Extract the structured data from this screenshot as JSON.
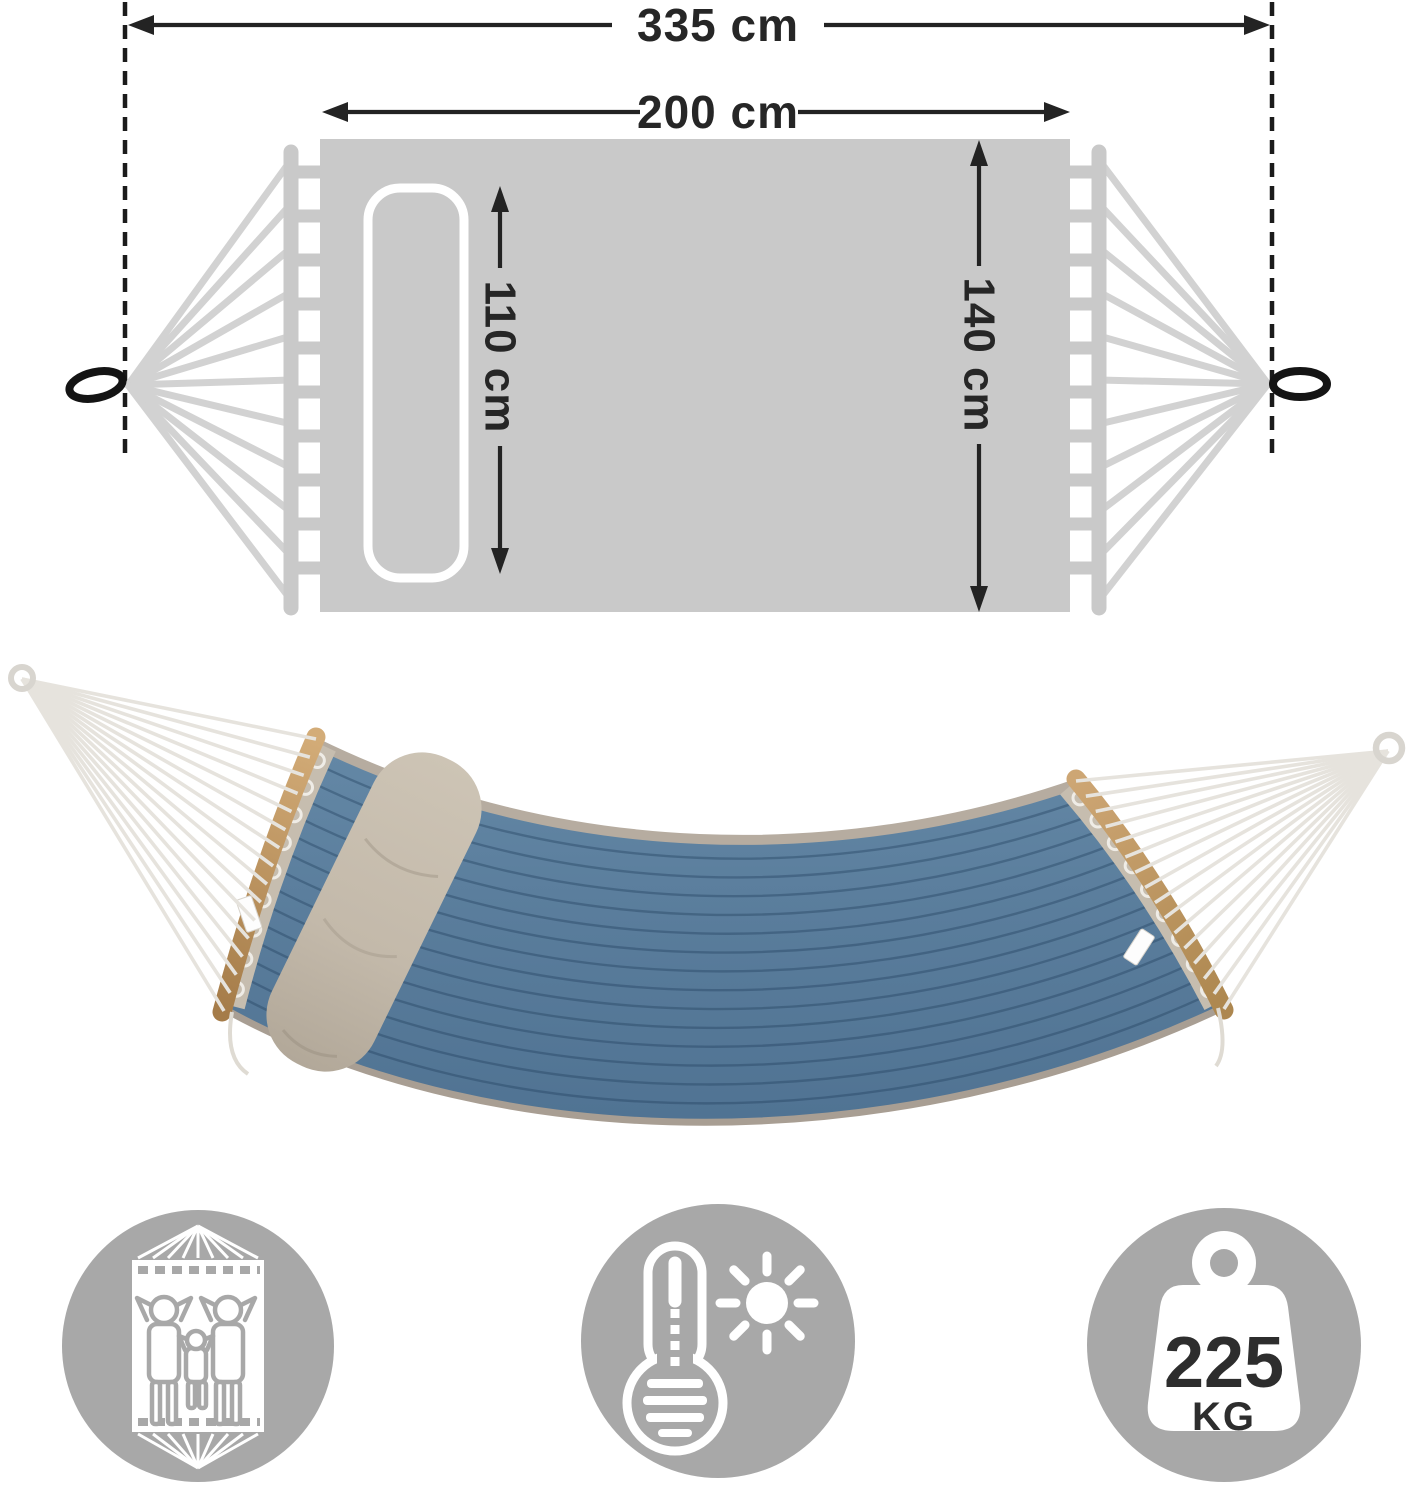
{
  "diagram": {
    "total_length_label": "335 cm",
    "bed_length_label": "200 cm",
    "pillow_length_label": "110 cm",
    "bed_width_label": "140 cm"
  },
  "features": {
    "capacity": {
      "icon": "family-in-hammock-icon"
    },
    "weather": {
      "icon": "thermometer-sun-icon"
    },
    "max_load": {
      "icon": "weight-icon",
      "value": "225",
      "unit": "KG"
    }
  },
  "colors": {
    "diagram_gray": "#c9c9c9",
    "diagram_rope_gray": "#d2d2d2",
    "line_dark": "#232323",
    "icon_circle_gray": "#a8a8a8",
    "hammock_blue": "#5b7e9c",
    "quilt_stitch_blue": "#3f6287",
    "wood_tan": "#c2995f",
    "pillow_khaki": "#c7bdae",
    "photo_rope": "#e6e3dd",
    "trim_greige": "#b6aca0"
  }
}
